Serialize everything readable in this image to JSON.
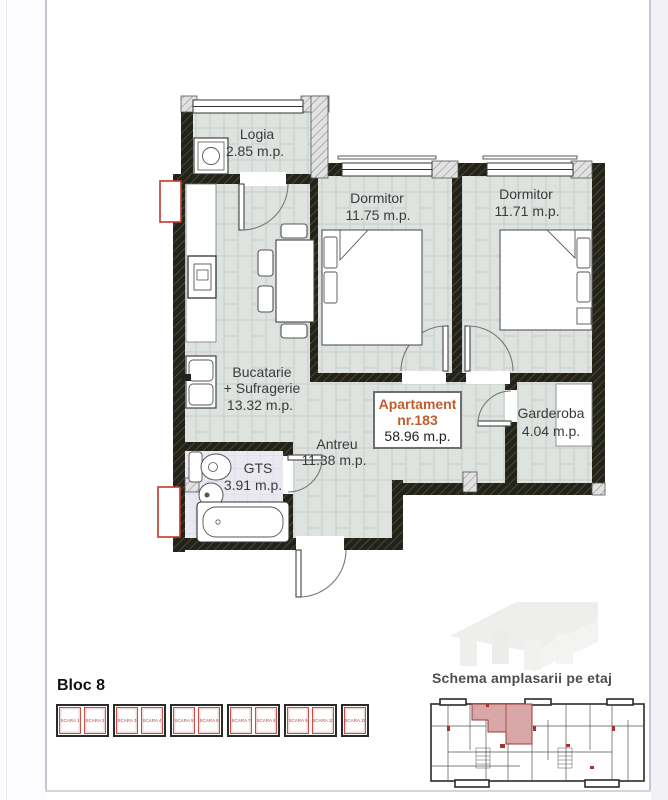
{
  "plan": {
    "apartment_label": {
      "line1": "Apartament",
      "line2": "nr.183",
      "area": "58.96 m.p."
    },
    "rooms": {
      "logia": {
        "name": "Logia",
        "area": "2.85 m.p."
      },
      "dormitor_1": {
        "name": "Dormitor",
        "area": "11.75 m.p."
      },
      "dormitor_2": {
        "name": "Dormitor",
        "area": "11.71 m.p."
      },
      "bucatarie": {
        "line1": "Bucatarie",
        "line2": "+ Sufragerie",
        "area": "13.32 m.p."
      },
      "antreu": {
        "name": "Antreu",
        "area": "11.38 m.p."
      },
      "garderoba": {
        "name": "Garderoba",
        "area": "4.04 m.p."
      },
      "gts": {
        "name": "GTS",
        "area": "3.91 m.p."
      }
    }
  },
  "footer": {
    "bloc_title": "Bloc 8",
    "scara_items": [
      "SCARA 1",
      "SCARA 2",
      "SCARA 3",
      "SCARA 4",
      "SCARA 5",
      "SCARA 6",
      "SCARA 7",
      "SCARA 8",
      "SCARA 9",
      "SCARA 10",
      "SCARA 11"
    ],
    "scara_groups": [
      [
        0,
        1
      ],
      [
        2,
        3
      ],
      [
        4,
        5
      ],
      [
        6,
        7
      ],
      [
        8,
        9
      ],
      [
        10
      ]
    ],
    "schema_title": "Schema amplasarii pe etaj"
  },
  "colors": {
    "accent_orange": "#c25e2d",
    "scara_red": "#b5433d",
    "highlight_pink": "#d9a7a7",
    "wall_dark": "#21211a",
    "floor_tile": "#dee3e0",
    "bath_tile": "#eae9f2"
  }
}
